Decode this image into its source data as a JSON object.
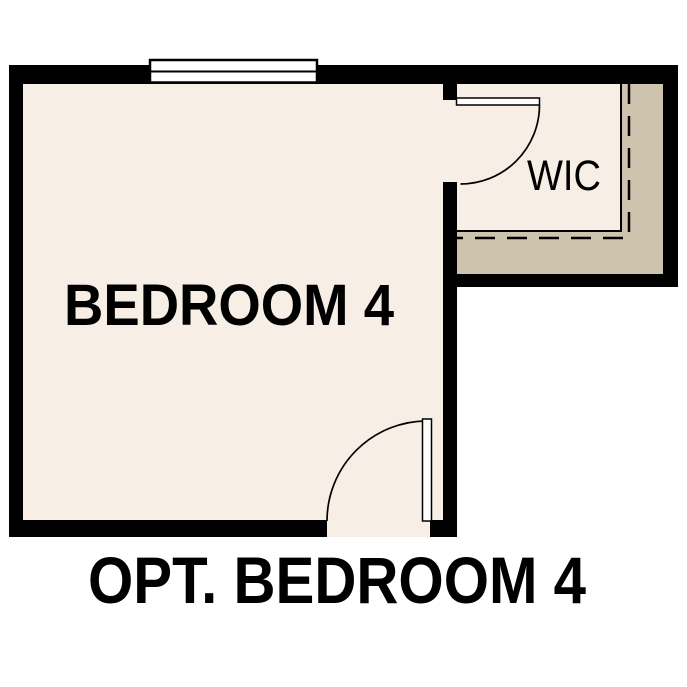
{
  "plan": {
    "caption": "OPT. BEDROOM 4",
    "rooms": {
      "bedroom": {
        "label": "BEDROOM 4"
      },
      "wic": {
        "label": "WIC"
      }
    }
  },
  "colors": {
    "background": "#ffffff",
    "floor": "#f7efe5",
    "closet_band": "#cec4ad",
    "wall": "#000000",
    "fixture_fill": "#ffffff",
    "line": "#000000"
  },
  "symbols": {
    "window": "double-pane-window",
    "wic_door": "door-swing-arc",
    "entry_door": "door-swing-arc",
    "closet_shelf_line": "dashed-shelf-outline"
  }
}
